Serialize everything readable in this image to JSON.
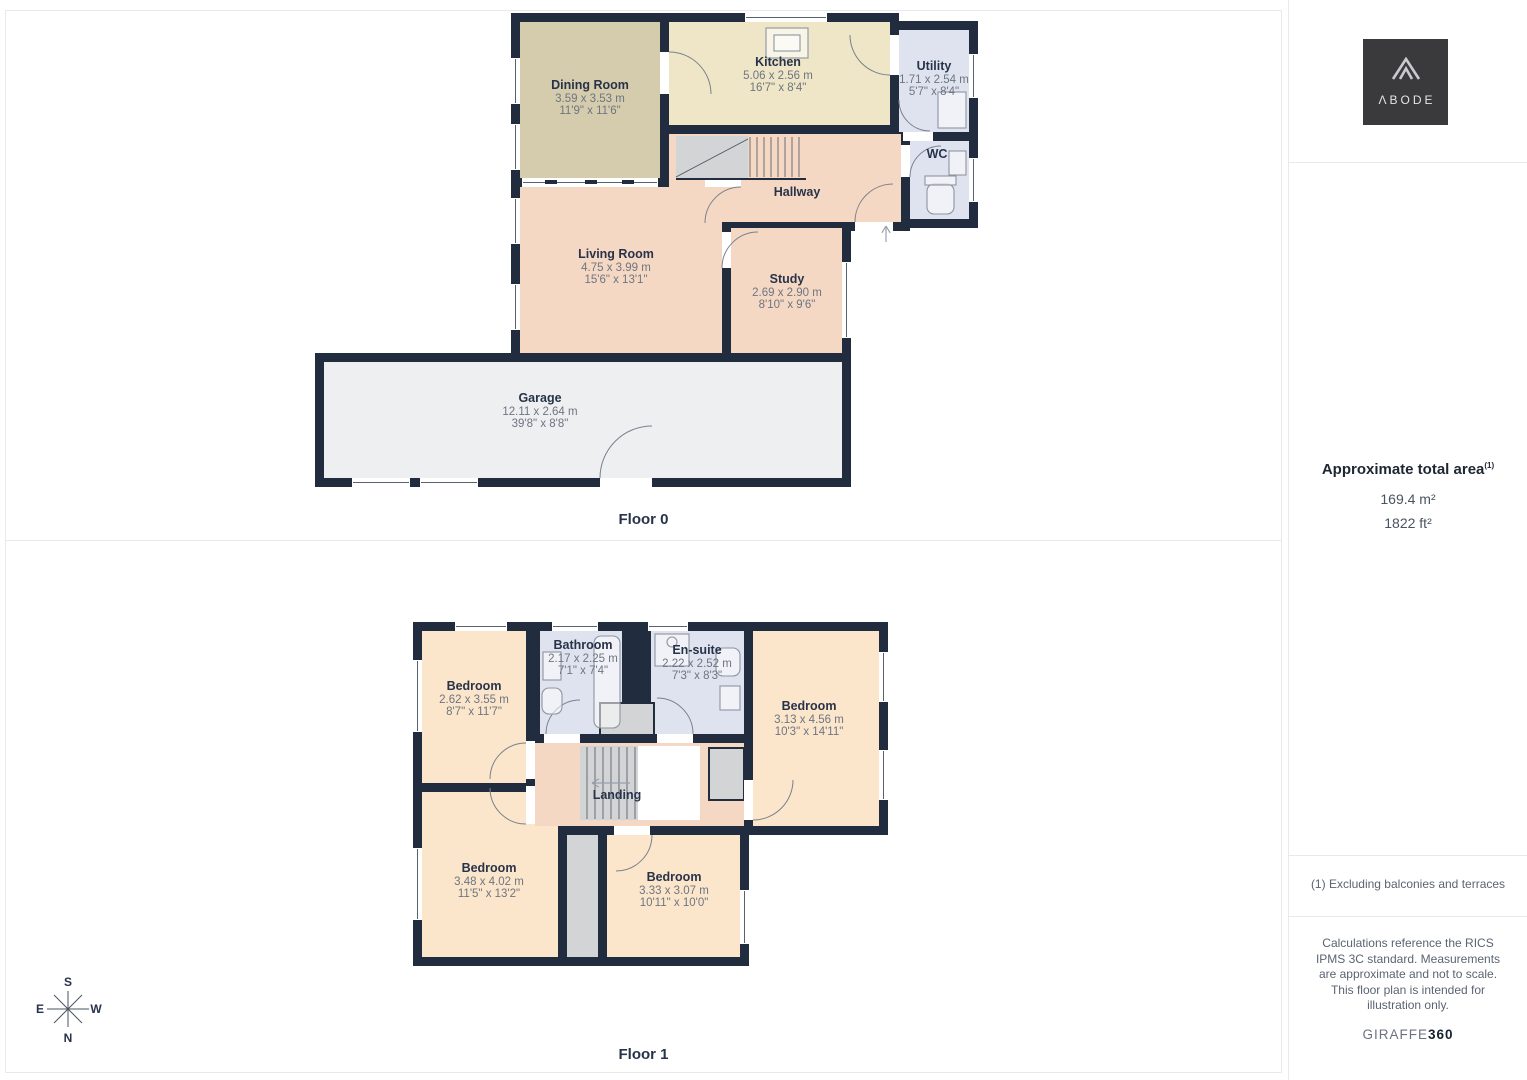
{
  "colors": {
    "wall": "#212c3e",
    "tan": "#d5ccae",
    "cream": "#efe6c8",
    "blue": "#dfe3ef",
    "pink": "#f5d8c4",
    "peach": "#fbe6cb",
    "garage": "#edeff1",
    "grey": "#d2d4d6",
    "label": "#283349",
    "dims": "#6e7580"
  },
  "sidebar": {
    "logo_text": "ΛBODE",
    "area_title": "Approximate total area",
    "area_sup": "(1)",
    "area_m2": "169.4 m²",
    "area_ft2": "1822 ft²",
    "footnote": "(1) Excluding balconies and terraces",
    "disclaimer": "Calculations reference the RICS IPMS 3C standard. Measurements are approximate and not to scale. This floor plan is intended for illustration only.",
    "brand_light": "GIRAFFE",
    "brand_bold": "360"
  },
  "compass": {
    "top": "S",
    "bottom": "N",
    "left": "E",
    "right": "W"
  },
  "floor0": {
    "key": "floor0",
    "label": "Floor 0",
    "viewBox": "300 12 690 486",
    "size": [
      690,
      486
    ],
    "rooms": [
      {
        "key": "dining-room",
        "name": "Dining Room",
        "dim_m": "3.59 x 3.53 m",
        "dim_ft": "11'9\" x 11'6\"",
        "fill": "tan",
        "rect": [
          520,
          22,
          140,
          156
        ],
        "label_at": [
          590,
          89
        ]
      },
      {
        "key": "kitchen",
        "name": "Kitchen",
        "dim_m": "5.06 x 2.56 m",
        "dim_ft": "16'7\" x 8'4\"",
        "fill": "cream",
        "rect": [
          669,
          22,
          221,
          103
        ],
        "label_at": [
          778,
          66
        ]
      },
      {
        "key": "utility",
        "name": "Utility",
        "dim_m": "1.71 x 2.54 m",
        "dim_ft": "5'7\" x 8'4\"",
        "fill": "blue",
        "rect": [
          899,
          30,
          70,
          102
        ],
        "label_at": [
          934,
          70
        ]
      },
      {
        "key": "wc",
        "name": "WC",
        "fill": "blue",
        "rect": [
          910,
          141,
          59,
          78
        ],
        "label_at": [
          937,
          158
        ]
      },
      {
        "key": "hallway",
        "name": "Hallway",
        "fill": "pink",
        "rect": [
          669,
          134,
          232,
          88
        ],
        "label_at": [
          797,
          196
        ]
      },
      {
        "key": "living-room",
        "name": "Living Room",
        "dim_m": "4.75 x 3.99 m",
        "dim_ft": "15'6\" x 13'1\"",
        "fill": "pink",
        "rect": [
          520,
          187,
          202,
          166
        ],
        "label_at": [
          616,
          258
        ]
      },
      {
        "key": "study",
        "name": "Study",
        "dim_m": "2.69 x 2.90 m",
        "dim_ft": "8'10\" x 9'6\"",
        "fill": "pink",
        "rect": [
          731,
          228,
          111,
          125
        ],
        "label_at": [
          787,
          283
        ]
      },
      {
        "key": "garage",
        "name": "Garage",
        "dim_m": "12.11 x 2.64 m",
        "dim_ft": "39'8\" x 8'8\"",
        "fill": "garage",
        "rect": [
          324,
          362,
          518,
          116
        ],
        "label_at": [
          540,
          402
        ]
      }
    ],
    "walls": [
      [
        610,
        353,
        38,
        42
      ],
      [
        655,
        173,
        50,
        14
      ]
    ],
    "windows": [
      [
        511,
        58,
        9,
        46
      ],
      [
        511,
        124,
        9,
        46
      ],
      [
        745,
        13,
        82,
        9
      ],
      [
        969,
        54,
        9,
        44
      ],
      [
        969,
        158,
        9,
        44
      ],
      [
        511,
        198,
        9,
        46
      ],
      [
        511,
        284,
        9,
        46
      ],
      [
        842,
        262,
        9,
        76
      ],
      [
        352,
        478,
        58,
        9
      ],
      [
        420,
        478,
        58,
        9
      ],
      [
        522,
        178,
        136,
        9
      ]
    ],
    "openings": [
      [
        660,
        52,
        9,
        42
      ],
      [
        890,
        35,
        9,
        40
      ],
      [
        903,
        132,
        30,
        9
      ],
      [
        901,
        145,
        9,
        32
      ],
      [
        705,
        178,
        36,
        9
      ],
      [
        722,
        232,
        9,
        36
      ],
      [
        855,
        222,
        38,
        9
      ],
      [
        600,
        478,
        52,
        9
      ]
    ],
    "stairs": [
      {
        "op": "rect",
        "r": [
          676,
          136,
          72,
          42
        ],
        "fill": "grey"
      },
      {
        "op": "vlines",
        "x1": 750,
        "x2": 804,
        "step": 7,
        "y1": 137,
        "y2": 177
      },
      {
        "op": "line",
        "l": [
          676,
          177,
          748,
          139
        ]
      },
      {
        "op": "line",
        "l": [
          676,
          179,
          806,
          179
        ],
        "c": "wall",
        "w": 2
      },
      {
        "op": "rect",
        "r": [
          545,
          180,
          12,
          4
        ],
        "fill": "wall"
      },
      {
        "op": "rect",
        "r": [
          585,
          180,
          12,
          4
        ],
        "fill": "wall"
      },
      {
        "op": "rect",
        "r": [
          622,
          180,
          12,
          4
        ],
        "fill": "wall"
      }
    ],
    "doors": [
      "M 669,52 A 42,42 0 0,1 711,94",
      "M 850,35 A 40,40 0 0,0 890,75",
      "M 899,100 A 31,31 0 0,0 930,131",
      "M 910,177 A 31,31 0 0,1 941,146",
      "M 741,187 A 36,36 0 0,0 705,223",
      "M 722,268 A 36,36 0 0,1 758,232",
      "M 855,222 A 38,38 0 0,1 893,184",
      "M 600,478 A 52,52 0 0,1 652,426"
    ],
    "fixtures": [
      {
        "t": "r",
        "r": [
          766,
          28,
          42,
          30
        ]
      },
      {
        "t": "r",
        "r": [
          774,
          35,
          26,
          16
        ]
      },
      {
        "t": "r",
        "r": [
          938,
          92,
          28,
          36
        ]
      },
      {
        "t": "rr",
        "r": [
          927,
          184,
          27,
          30
        ]
      },
      {
        "t": "r",
        "r": [
          925,
          176,
          31,
          9
        ]
      },
      {
        "t": "r",
        "r": [
          949,
          151,
          17,
          24
        ]
      }
    ],
    "arrows": [
      [
        [
          886,
          242
        ],
        [
          886,
          226
        ]
      ]
    ]
  },
  "floor1": {
    "key": "floor1",
    "label": "Floor 1",
    "viewBox": "404 610 494 360",
    "size": [
      494,
      360
    ],
    "rooms": [
      {
        "key": "bedroom-1",
        "name": "Bedroom",
        "dim_m": "2.62 x 3.55 m",
        "dim_ft": "8'7\" x 11'7\"",
        "fill": "peach",
        "rect": [
          422,
          631,
          104,
          152
        ],
        "label_at": [
          474,
          690
        ]
      },
      {
        "key": "bathroom",
        "name": "Bathroom",
        "dim_m": "2.17 x 2.25 m",
        "dim_ft": "7'1\" x 7'4\"",
        "fill": "blue",
        "rect": [
          540,
          631,
          82,
          103
        ],
        "label_at": [
          583,
          649
        ]
      },
      {
        "key": "en-suite",
        "name": "En-suite",
        "dim_m": "2.22 x 2.52 m",
        "dim_ft": "7'3\" x 8'3\"",
        "fill": "blue",
        "rect": [
          651,
          631,
          93,
          103
        ],
        "label_at": [
          697,
          654
        ]
      },
      {
        "key": "bedroom-2",
        "name": "Bedroom",
        "dim_m": "3.13 x 4.56 m",
        "dim_ft": "10'3\" x 14'11\"",
        "fill": "peach",
        "rect": [
          753,
          631,
          126,
          195
        ],
        "label_at": [
          809,
          710
        ]
      },
      {
        "key": "bedroom-3",
        "name": "Bedroom",
        "dim_m": "3.48 x 4.02 m",
        "dim_ft": "11'5\" x 13'2\"",
        "fill": "peach",
        "rect": [
          422,
          792,
          136,
          165
        ],
        "label_at": [
          489,
          872
        ]
      },
      {
        "key": "corridor",
        "fill": "grey",
        "rect": [
          567,
          835,
          31,
          122
        ],
        "label_at": [
          582,
          880
        ]
      },
      {
        "key": "bedroom-4",
        "name": "Bedroom",
        "dim_m": "3.33 x 3.07 m",
        "dim_ft": "10'11\" x 10'0\"",
        "fill": "peach",
        "rect": [
          607,
          835,
          133,
          122
        ],
        "label_at": [
          674,
          881
        ]
      },
      {
        "key": "landing",
        "name": "Landing",
        "fill": "pink",
        "rect": [
          535,
          743,
          209,
          83
        ],
        "label_at": [
          617,
          799
        ]
      }
    ],
    "walls": [
      [
        622,
        622,
        29,
        121
      ],
      [
        526,
        792,
        9,
        43
      ],
      [
        698,
        743,
        9,
        83
      ]
    ],
    "greys": [
      [
        600,
        703,
        54,
        32
      ],
      [
        709,
        748,
        35,
        52
      ]
    ],
    "windows": [
      [
        413,
        660,
        9,
        72
      ],
      [
        413,
        848,
        9,
        72
      ],
      [
        455,
        622,
        52,
        9
      ],
      [
        552,
        622,
        46,
        9
      ],
      [
        648,
        622,
        40,
        9
      ],
      [
        879,
        652,
        9,
        50
      ],
      [
        879,
        750,
        9,
        50
      ],
      [
        740,
        890,
        9,
        54
      ]
    ],
    "openings": [
      [
        526,
        741,
        9,
        38
      ],
      [
        526,
        786,
        9,
        38
      ],
      [
        544,
        734,
        36,
        9
      ],
      [
        657,
        734,
        36,
        9
      ],
      [
        744,
        780,
        9,
        40
      ],
      [
        614,
        826,
        36,
        9
      ]
    ],
    "stairs": [
      {
        "op": "rect",
        "r": [
          580,
          746,
          58,
          74
        ],
        "fill": "grey"
      },
      {
        "op": "rect",
        "r": [
          638,
          746,
          62,
          74
        ],
        "fill": "white"
      },
      {
        "op": "vlines",
        "x1": 587,
        "x2": 635,
        "step": 8,
        "y1": 747,
        "y2": 819
      }
    ],
    "doors": [
      "M 526,743 A 36,36 0 0,0 490,779",
      "M 526,824 A 36,36 0 0,1 490,788",
      "M 546,734 A 34,34 0 0,1 580,700",
      "M 693,734 A 36,36 0 0,0 657,698",
      "M 753,820 A 40,40 0 0,0 793,780",
      "M 652,835 A 36,36 0 0,1 616,871"
    ],
    "fixtures": [
      {
        "t": "rr",
        "r": [
          594,
          636,
          26,
          92
        ]
      },
      {
        "t": "r",
        "r": [
          543,
          652,
          18,
          28
        ]
      },
      {
        "t": "rr",
        "r": [
          542,
          688,
          20,
          26
        ]
      },
      {
        "t": "r",
        "r": [
          655,
          634,
          34,
          32
        ]
      },
      {
        "t": "c",
        "c": [
          672,
          642,
          5
        ]
      },
      {
        "t": "rr",
        "r": [
          716,
          648,
          24,
          28
        ]
      },
      {
        "t": "r",
        "r": [
          720,
          686,
          20,
          24
        ]
      }
    ],
    "arrows": [
      [
        [
          630,
          783
        ],
        [
          592,
          783
        ]
      ]
    ]
  }
}
